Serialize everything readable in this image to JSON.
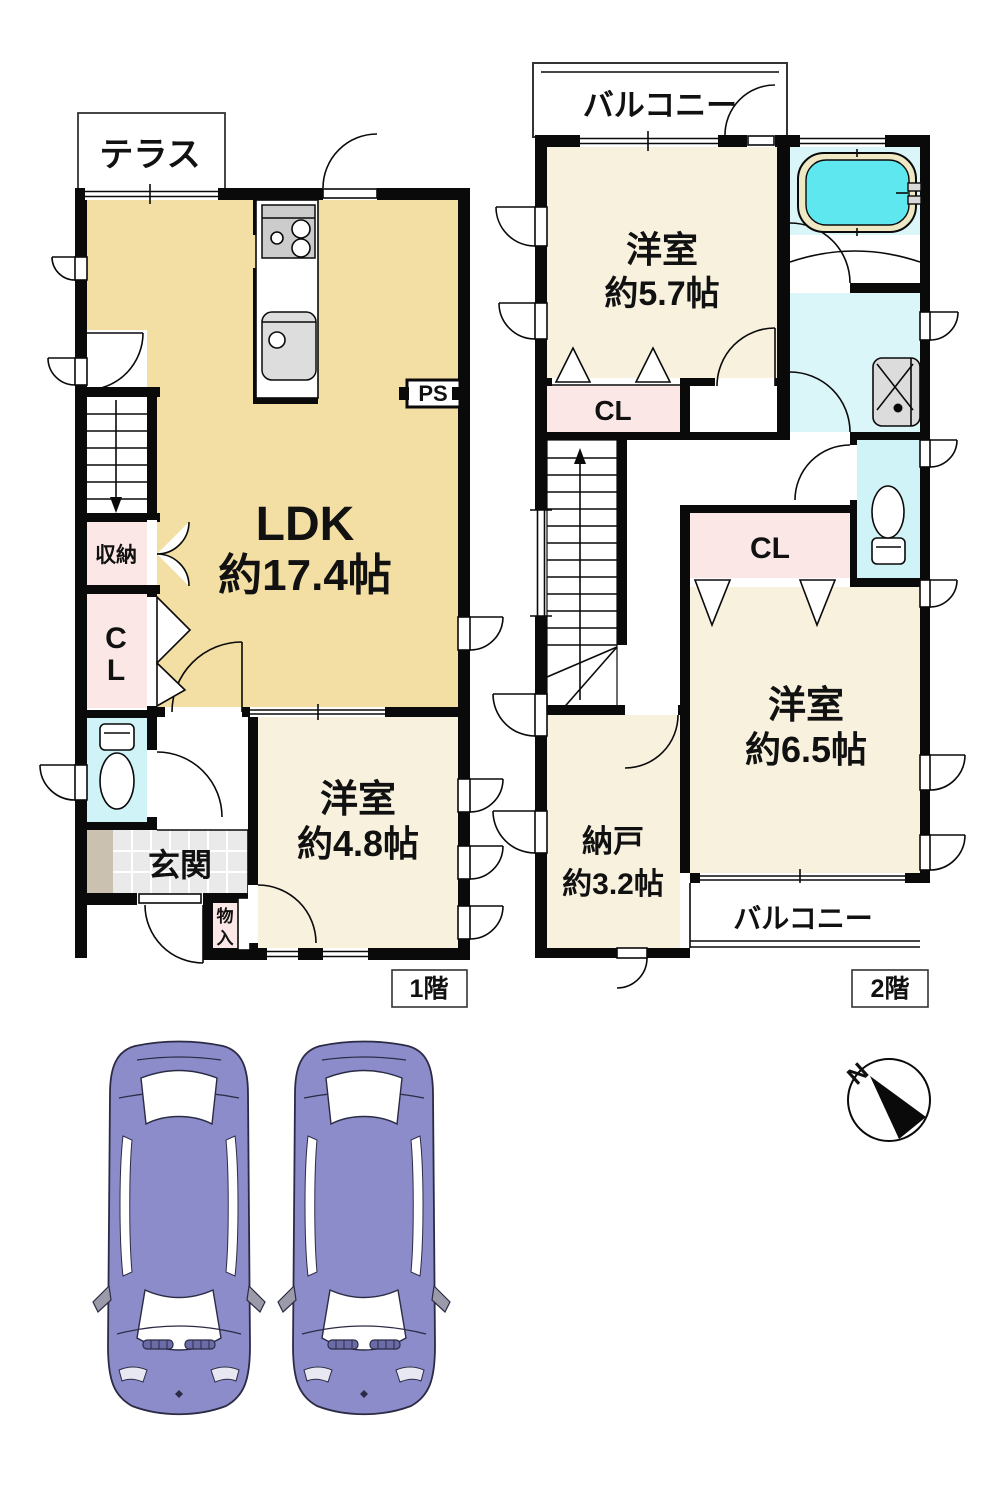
{
  "floor1": {
    "floor_label": "1階",
    "terrace": "テラス",
    "ldk_name": "LDK",
    "ldk_size": "約17.4帖",
    "ps": "PS",
    "storage": "収納",
    "closet_c": "C",
    "closet_l": "L",
    "entrance": "玄関",
    "small_storage_1": "物",
    "small_storage_2": "入",
    "western_room_name": "洋室",
    "western_room_size": "約4.8帖"
  },
  "floor2": {
    "floor_label": "2階",
    "balcony_top": "バルコニー",
    "western_room_57_name": "洋室",
    "western_room_57_size": "約5.7帖",
    "closet_top": "CL",
    "closet_mid": "CL",
    "western_room_65_name": "洋室",
    "western_room_65_size": "約6.5帖",
    "storeroom_name": "納戸",
    "storeroom_size": "約3.2帖",
    "balcony_bottom": "バルコニー"
  },
  "compass": {
    "north": "N"
  },
  "parking": {
    "car_count": 2
  },
  "colors": {
    "ldk_tan": "#F3DFA3",
    "room_cream": "#F7F1DE",
    "closet_pink": "#FBE7E6",
    "toilet_cyan": "#CFF3F7",
    "bath_cyan": "#DBF6F9",
    "tub_water": "#5FE7F0",
    "tub_rim": "#EFE8C4",
    "entrance_tile": "#EAEAEA",
    "porch": "#CBC1B1",
    "car_body": "#8C8CCA",
    "wall": "#0A0A0A"
  }
}
